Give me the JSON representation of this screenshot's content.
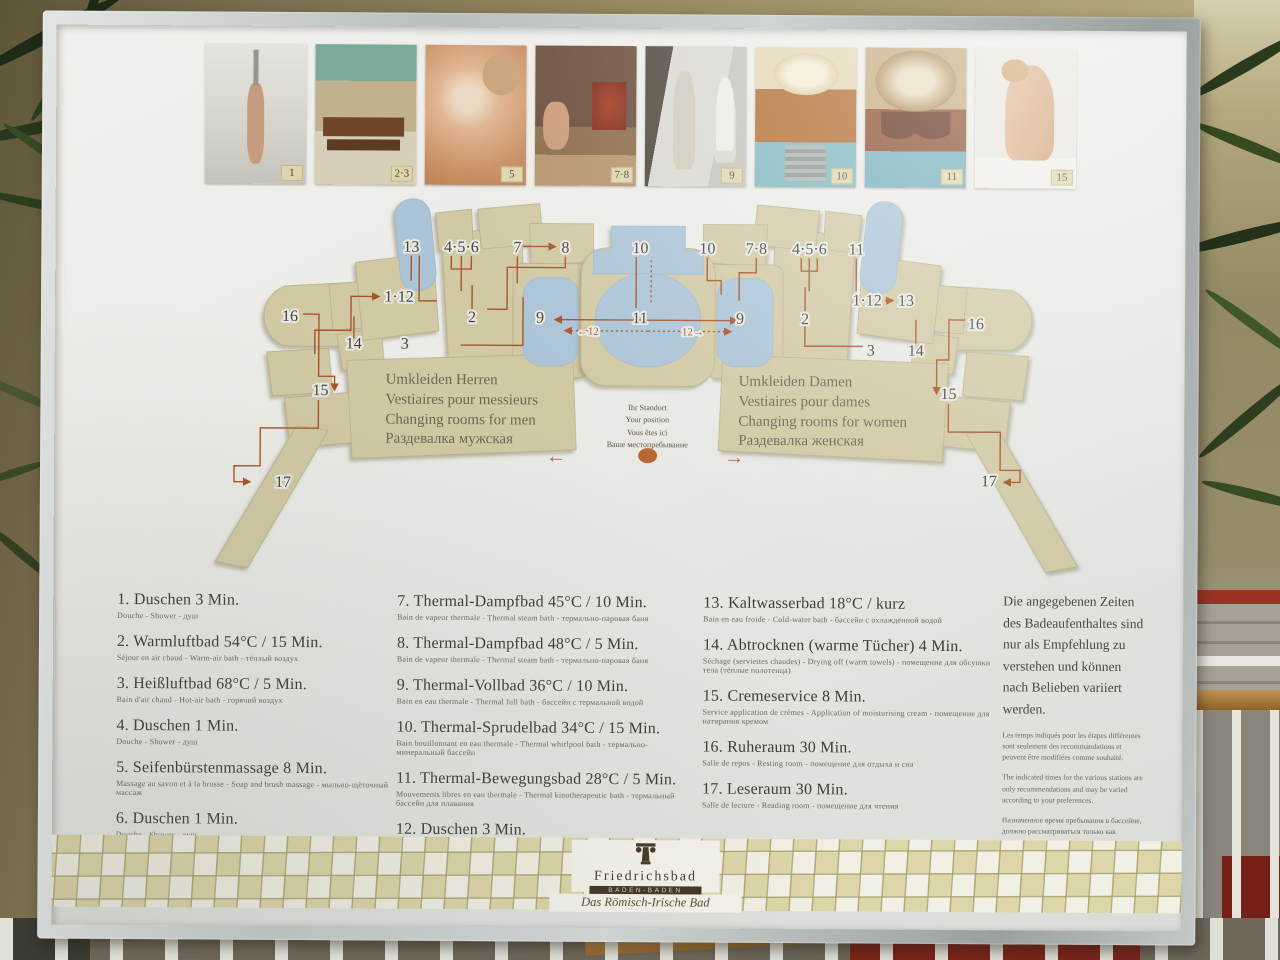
{
  "colors": {
    "route": "#a8542a",
    "pool": "#abc4d7",
    "room": "#d1c9a4",
    "accent_dot": "#b5672f",
    "logo_bar": "#42372a"
  },
  "board": {
    "photos": [
      {
        "label": "1",
        "kind": "shower"
      },
      {
        "label": "2·3",
        "kind": "warm-air"
      },
      {
        "label": "5",
        "kind": "massage"
      },
      {
        "label": "7·8",
        "kind": "steam"
      },
      {
        "label": "9",
        "kind": "statue"
      },
      {
        "label": "10",
        "kind": "dome-pool"
      },
      {
        "label": "11",
        "kind": "dome-hall"
      },
      {
        "label": "15",
        "kind": "cream"
      }
    ],
    "map": {
      "changing_men": [
        "Umkleiden Herren",
        "Vestiaires pour messieurs",
        "Changing rooms for men",
        "Раздевалка мужская"
      ],
      "changing_women": [
        "Umkleiden Damen",
        "Vestiaires pour dames",
        "Changing rooms for women",
        "Раздевалка женская"
      ],
      "standort": [
        "Ihr Standort",
        "Your position",
        "Vous êtes ici",
        "Ваше местопребывание"
      ],
      "arrow_left": "←",
      "arrow_right": "→",
      "labels": [
        {
          "t": "13",
          "x": 412,
          "y": 255
        },
        {
          "t": "4·5·6",
          "x": 462,
          "y": 255
        },
        {
          "t": "7",
          "x": 518,
          "y": 255
        },
        {
          "t": "8",
          "x": 566,
          "y": 255
        },
        {
          "t": "1·12",
          "x": 400,
          "y": 305
        },
        {
          "t": "2",
          "x": 473,
          "y": 325
        },
        {
          "t": "9",
          "x": 541,
          "y": 325
        },
        {
          "t": "16",
          "x": 291,
          "y": 325
        },
        {
          "t": "14",
          "x": 355,
          "y": 352
        },
        {
          "t": "3",
          "x": 406,
          "y": 352
        },
        {
          "t": "15",
          "x": 322,
          "y": 399
        },
        {
          "t": "17",
          "x": 285,
          "y": 491
        },
        {
          "t": "10",
          "x": 641,
          "y": 255
        },
        {
          "t": "11",
          "x": 641,
          "y": 325
        },
        {
          "t": "←12",
          "x": 589,
          "y": 337
        },
        {
          "t": "12→",
          "x": 694,
          "y": 337
        },
        {
          "t": "10",
          "x": 708,
          "y": 255
        },
        {
          "t": "7·8",
          "x": 757,
          "y": 255
        },
        {
          "t": "4·5·6",
          "x": 810,
          "y": 255
        },
        {
          "t": "11",
          "x": 857,
          "y": 255
        },
        {
          "t": "1·12",
          "x": 868,
          "y": 306
        },
        {
          "t": "13",
          "x": 907,
          "y": 306
        },
        {
          "t": "9",
          "x": 741,
          "y": 325
        },
        {
          "t": "2",
          "x": 806,
          "y": 325
        },
        {
          "t": "3",
          "x": 872,
          "y": 356
        },
        {
          "t": "14",
          "x": 917,
          "y": 356
        },
        {
          "t": "16",
          "x": 977,
          "y": 329
        },
        {
          "t": "15",
          "x": 950,
          "y": 399
        },
        {
          "t": "17",
          "x": 991,
          "y": 486
        }
      ]
    },
    "legend": {
      "columns": [
        [
          {
            "title": "1. Duschen 3 Min.",
            "sub": "Douche - Shower - душ"
          },
          {
            "title": "2. Warmluftbad 54°C / 15 Min.",
            "sub": "Séjour en air chaud - Warm-air bath - тёплый воздух"
          },
          {
            "title": "3. Heißluftbad 68°C / 5 Min.",
            "sub": "Bain d'air chaud - Hot-air bath - горячий воздух"
          },
          {
            "title": "4. Duschen 1 Min.",
            "sub": "Douche - Shower - душ"
          },
          {
            "title": "5. Seifenbürstenmassage 8 Min.",
            "sub": "Massage au savon et à la brosse - Soap and brush massage - мыльно-щёточный массаж"
          },
          {
            "title": "6. Duschen 1 Min.",
            "sub": "Douche - Shower - душ"
          }
        ],
        [
          {
            "title": "7. Thermal-Dampfbad 45°C / 10 Min.",
            "sub": "Bain de vapeur thermale - Thermal steam bath - термально-паровая баня"
          },
          {
            "title": "8. Thermal-Dampfbad 48°C / 5 Min.",
            "sub": "Bain de vapeur thermale - Thermal steam bath - термально-паровая баня"
          },
          {
            "title": "9. Thermal-Vollbad 36°C / 10 Min.",
            "sub": "Bain en eau thermale - Thermal full bath - бассейн с термальной водой"
          },
          {
            "title": "10. Thermal-Sprudelbad 34°C / 15 Min.",
            "sub": "Bain bouillonnant en eau thermale - Thermal whirlpool bath - термально-минеральный бассейн"
          },
          {
            "title": "11. Thermal-Bewegungsbad 28°C / 5 Min.",
            "sub": "Mouvements libres en eau thermale - Thermal kinotherapeutic bath - термальный бассейн для плавания"
          },
          {
            "title": "12. Duschen 3 Min.",
            "sub": "Douche - Shower - душ"
          }
        ],
        [
          {
            "title": "13. Kaltwasserbad 18°C / kurz",
            "sub": "Bain en eau froide - Cold-water bath - бассейн с охлаждённой водой"
          },
          {
            "title": "14. Abtrocknen (warme Tücher) 4 Min.",
            "sub": "Séchage (serviettes chaudes) - Drying off (warm towels) - помещение для обсушки тела (тёплые полотенца)"
          },
          {
            "title": "15. Cremeservice 8 Min.",
            "sub": "Service application de crèmes - Application of moisturising cream - помещение для натирания кремом"
          },
          {
            "title": "16. Ruheraum 30 Min.",
            "sub": "Salle de repos - Resting room - помещение для отдыха и сна"
          },
          {
            "title": "17. Leseraum 30 Min.",
            "sub": "Salle de lecture - Reading room - помещение для чтения"
          }
        ]
      ]
    },
    "note": {
      "de": "Die angegebenen Zeiten des Badeaufenthaltes sind nur als Empfehlung zu verstehen und können nach Belieben variiert werden.",
      "fr": "Les temps indiqués pour les étapes différentes sont seulement des recommandations et peuvent être modifiées comme souhaité.",
      "en": "The indicated times for the various stations are only recommendations and may be varied according to your preferences.",
      "ru": "Назначенное время пребывания в бассейне, должно рассматриваться только как предложение и может варьироваться по вашему усмотрению."
    },
    "logo": {
      "name": "Friedrichsbad",
      "city": "BADEN-BADEN",
      "subtitle": "Das Römisch-Irische Bad"
    }
  }
}
